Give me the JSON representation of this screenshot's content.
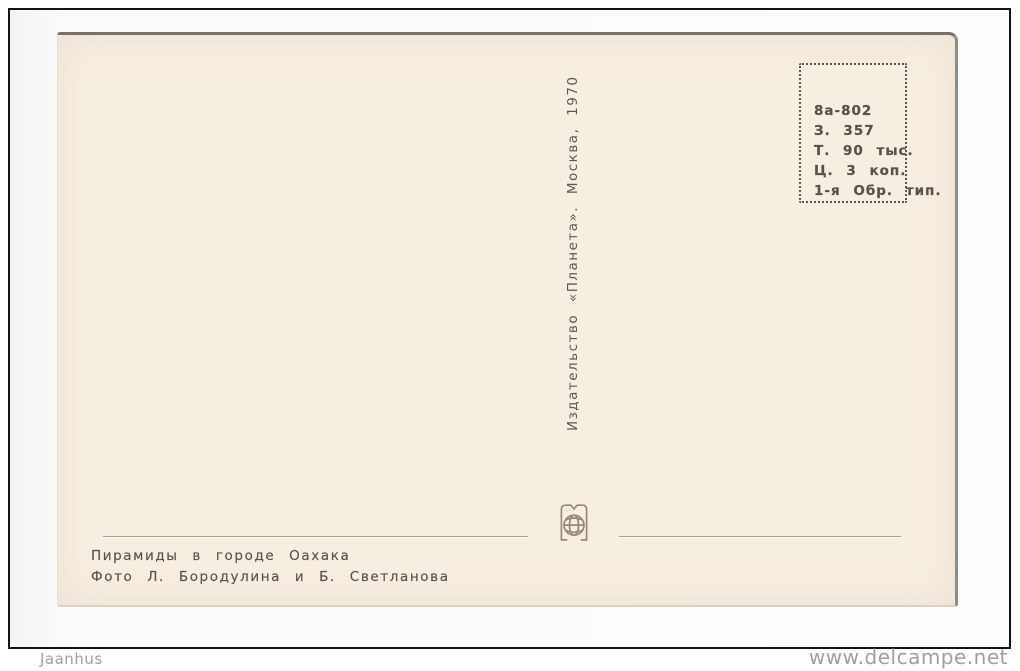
{
  "postcard": {
    "imprint_box": {
      "lines": [
        "8а-802",
        "З. 357",
        "Т. 90 тыс.",
        "Ц. 3 коп.",
        "1-я Обр. тип."
      ]
    },
    "publisher_line": "Издательство «Планета». Москва, 1970",
    "caption": {
      "title": "Пирамиды в городе Оахака",
      "credit": "Фото Л. Бородулина и Б. Светланова"
    },
    "logo": "planeta-publisher-globe-logo"
  },
  "watermarks": {
    "left": "Jaanhus",
    "right": "www.delcampe.net"
  },
  "colors": {
    "card_paper": "#f7eee2",
    "ink": "#57524b",
    "watermark_gray": "#9aa0a4",
    "frame_black": "#141414",
    "divider": "#ab9f91"
  }
}
